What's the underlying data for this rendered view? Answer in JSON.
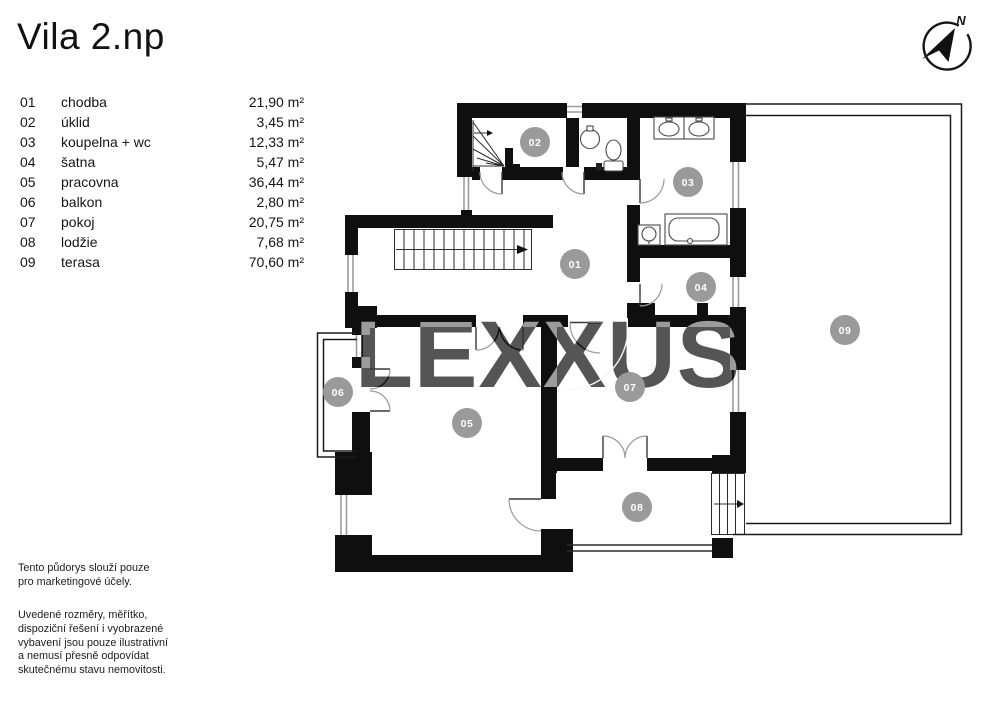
{
  "title": "Vila 2.np",
  "compass": {
    "north_label": "N"
  },
  "watermark": {
    "text": "LEXXUS"
  },
  "legend": {
    "rooms": [
      {
        "num": "01",
        "name": "chodba",
        "area": "21,90 m²"
      },
      {
        "num": "02",
        "name": "úklid",
        "area": "3,45 m²"
      },
      {
        "num": "03",
        "name": "koupelna + wc",
        "area": "12,33 m²"
      },
      {
        "num": "04",
        "name": "šatna",
        "area": "5,47 m²"
      },
      {
        "num": "05",
        "name": "pracovna",
        "area": "36,44 m²"
      },
      {
        "num": "06",
        "name": "balkon",
        "area": "2,80 m²"
      },
      {
        "num": "07",
        "name": "pokoj",
        "area": "20,75 m²"
      },
      {
        "num": "08",
        "name": "lodžie",
        "area": "7,68 m²"
      },
      {
        "num": "09",
        "name": "terasa",
        "area": "70,60 m²"
      }
    ]
  },
  "disclaimer": {
    "paragraph1": "Tento půdorys slouží pouze\npro marketingové účely.",
    "paragraph2": "Uvedené rozměry, měřítko,\ndispoziční řešení i vyobrazené\nvybavení jsou pouze ilustrativní\na nemusí přesně odpovídat\nskutečnému stavu nemovitosti."
  },
  "colors": {
    "wall": "#0f0f0f",
    "badge_fill": "#9a9a9a",
    "watermark_fill": "#aaaaaa"
  }
}
